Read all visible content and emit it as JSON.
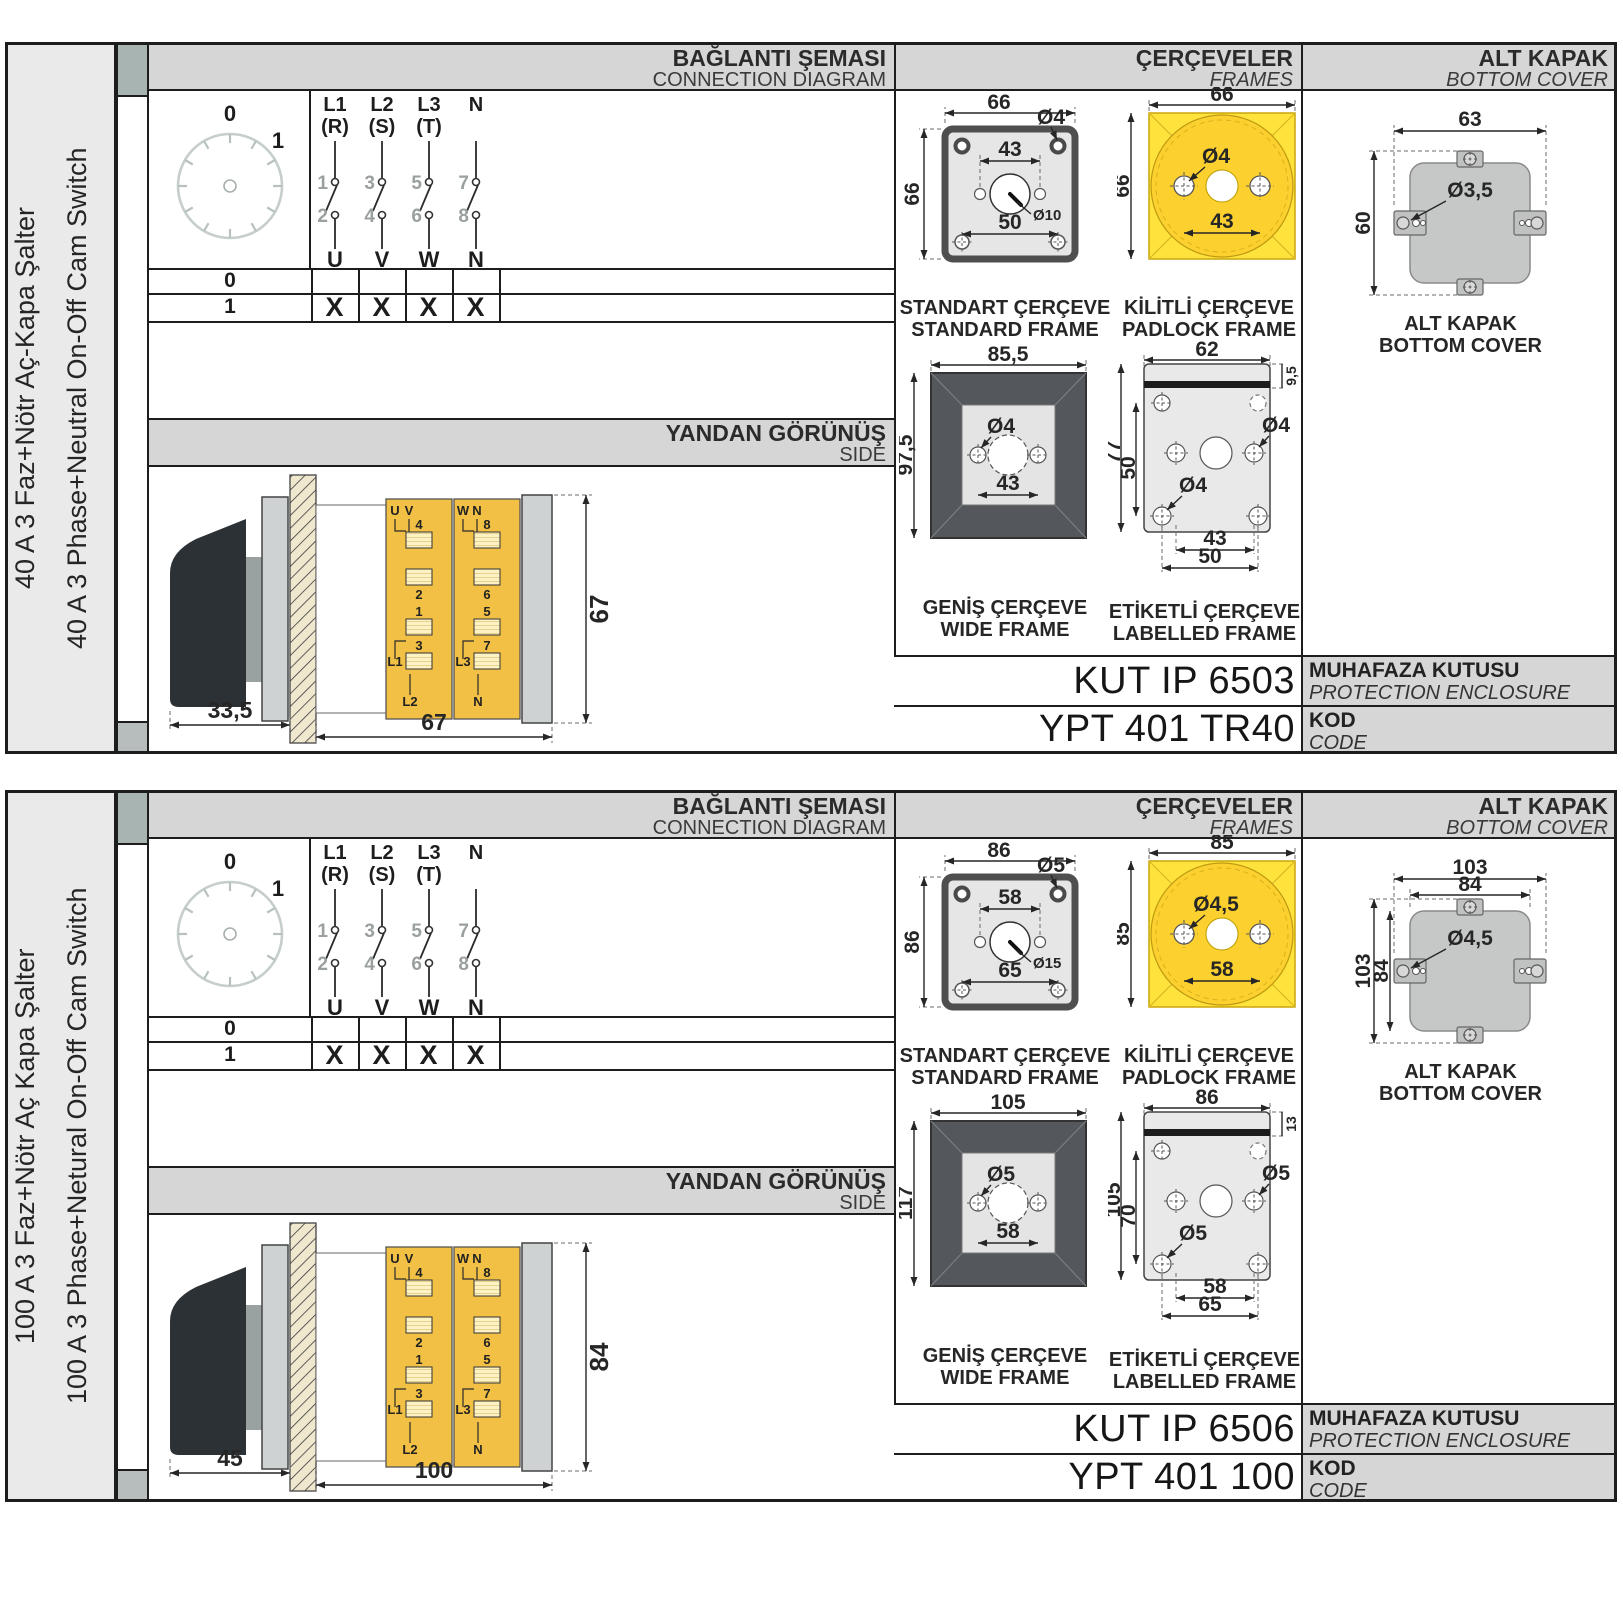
{
  "sections": [
    {
      "sidebar": {
        "tr": "40 A 3 Faz+Nötr Aç-Kapa Şalter",
        "en": "40 A 3 Phase+Neutral On-Off Cam Switch"
      },
      "headers": {
        "connection": {
          "tr": "BAĞLANTI ŞEMASI",
          "en": "CONNECTION DIAGRAM"
        },
        "frames": {
          "tr": "ÇERÇEVELER",
          "en": "FRAMES"
        },
        "cover": {
          "tr": "ALT KAPAK",
          "en": "BOTTOM COVER"
        }
      },
      "diagram": {
        "positions": {
          "off": "0",
          "on": "1"
        },
        "poles": [
          {
            "line": "L1",
            "phase": "(R)",
            "t_in": "1",
            "t_out": "2",
            "out": "U"
          },
          {
            "line": "L2",
            "phase": "(S)",
            "t_in": "3",
            "t_out": "4",
            "out": "V"
          },
          {
            "line": "L3",
            "phase": "(T)",
            "t_in": "5",
            "t_out": "6",
            "out": "W"
          },
          {
            "line": "N",
            "phase": "",
            "t_in": "7",
            "t_out": "8",
            "out": "N"
          }
        ],
        "table": {
          "row_off": {
            "label": "0",
            "marks": [
              "",
              "",
              "",
              ""
            ]
          },
          "row_on": {
            "label": "1",
            "marks": [
              "X",
              "X",
              "X",
              "X"
            ]
          }
        }
      },
      "sideview": {
        "title": {
          "tr": "YANDAN GÖRÜNÜŞ",
          "en": "SIDE"
        },
        "dims": {
          "depth": "33,5",
          "width": "67",
          "height": "67"
        },
        "col1": {
          "top1": "U",
          "top2": "V",
          "n1": "4",
          "n2": "2",
          "n3": "1",
          "n4": "3",
          "b1": "L1",
          "b2": "L2"
        },
        "col2": {
          "top1": "W",
          "top2": "N",
          "n1": "8",
          "n2": "6",
          "n3": "5",
          "n4": "7",
          "b1": "L3",
          "b2": "N"
        }
      },
      "frames": {
        "standard": {
          "caption_tr": "STANDART ÇERÇEVE",
          "caption_en": "STANDARD FRAME",
          "w": "66",
          "h": "66",
          "hole": "Ø4",
          "span": "43",
          "knob": "Ø10",
          "holes_w": "50"
        },
        "padlock": {
          "caption_tr": "KİLİTLİ ÇERÇEVE",
          "caption_en": "PADLOCK FRAME",
          "w": "66",
          "h": "66",
          "hole": "Ø4",
          "span": "43"
        },
        "wide": {
          "caption_tr": "GENİŞ ÇERÇEVE",
          "caption_en": "WIDE FRAME",
          "w": "85,5",
          "h": "97,5",
          "hole": "Ø4",
          "span": "43"
        },
        "labelled": {
          "caption_tr": "ETİKETLİ ÇERÇEVE",
          "caption_en": "LABELLED FRAME",
          "w": "62",
          "strip": "9,5",
          "h": "77",
          "inner_h": "50",
          "hole_top": "Ø4",
          "hole_bottom": "Ø4",
          "span1": "43",
          "span2": "50"
        }
      },
      "cover": {
        "caption_tr": "ALT KAPAK",
        "caption_en": "BOTTOM COVER",
        "w": "63",
        "hole": "Ø3,5",
        "h": "60",
        "extra_class": "hide"
      },
      "codes": {
        "enclosure": {
          "value": "KUT IP 6503",
          "tr": "MUHAFAZA KUTUSU",
          "en": "PROTECTION ENCLOSURE"
        },
        "code": {
          "value": "YPT 401 TR40",
          "tr": "KOD",
          "en": "CODE"
        }
      }
    },
    {
      "sidebar": {
        "tr": "100 A 3 Faz+Nötr Aç Kapa Şalter",
        "en": "100 A 3 Phase+Netural On-Off Cam Switch"
      },
      "headers": {
        "connection": {
          "tr": "BAĞLANTI ŞEMASI",
          "en": "CONNECTION DIAGRAM"
        },
        "frames": {
          "tr": "ÇERÇEVELER",
          "en": "FRAMES"
        },
        "cover": {
          "tr": "ALT KAPAK",
          "en": "BOTTOM COVER"
        }
      },
      "diagram": {
        "positions": {
          "off": "0",
          "on": "1"
        },
        "poles": [
          {
            "line": "L1",
            "phase": "(R)",
            "t_in": "1",
            "t_out": "2",
            "out": "U"
          },
          {
            "line": "L2",
            "phase": "(S)",
            "t_in": "3",
            "t_out": "4",
            "out": "V"
          },
          {
            "line": "L3",
            "phase": "(T)",
            "t_in": "5",
            "t_out": "6",
            "out": "W"
          },
          {
            "line": "N",
            "phase": "",
            "t_in": "7",
            "t_out": "8",
            "out": "N"
          }
        ],
        "table": {
          "row_off": {
            "label": "0",
            "marks": [
              "",
              "",
              "",
              ""
            ]
          },
          "row_on": {
            "label": "1",
            "marks": [
              "X",
              "X",
              "X",
              "X"
            ]
          }
        }
      },
      "sideview": {
        "title": {
          "tr": "YANDAN GÖRÜNÜŞ",
          "en": "SIDE"
        },
        "dims": {
          "depth": "45",
          "width": "100",
          "height": "84"
        },
        "col1": {
          "top1": "U",
          "top2": "V",
          "n1": "4",
          "n2": "2",
          "n3": "1",
          "n4": "3",
          "b1": "L1",
          "b2": "L2"
        },
        "col2": {
          "top1": "W",
          "top2": "N",
          "n1": "8",
          "n2": "6",
          "n3": "5",
          "n4": "7",
          "b1": "L3",
          "b2": "N"
        }
      },
      "frames": {
        "standard": {
          "caption_tr": "STANDART ÇERÇEVE",
          "caption_en": "STANDARD FRAME",
          "w": "86",
          "h": "86",
          "hole": "Ø5",
          "span": "58",
          "knob": "Ø15",
          "holes_w": "65"
        },
        "padlock": {
          "caption_tr": "KİLİTLİ ÇERÇEVE",
          "caption_en": "PADLOCK FRAME",
          "w": "85",
          "h": "85",
          "hole": "Ø4,5",
          "span": "58"
        },
        "wide": {
          "caption_tr": "GENİŞ ÇERÇEVE",
          "caption_en": "WIDE FRAME",
          "w": "105",
          "h": "117",
          "hole": "Ø5",
          "span": "58"
        },
        "labelled": {
          "caption_tr": "ETİKETLİ ÇERÇEVE",
          "caption_en": "LABELLED FRAME",
          "w": "86",
          "strip": "13",
          "h": "105",
          "inner_h": "70",
          "hole_top": "Ø5",
          "hole_bottom": "Ø5",
          "span1": "58",
          "span2": "65"
        }
      },
      "cover": {
        "caption_tr": "ALT KAPAK",
        "caption_en": "BOTTOM COVER",
        "w": "103",
        "w2": "84",
        "hole": "Ø4,5",
        "h": "103",
        "h2": "84",
        "extra_class": "show"
      },
      "codes": {
        "enclosure": {
          "value": "KUT IP 6506",
          "tr": "MUHAFAZA KUTUSU",
          "en": "PROTECTION ENCLOSURE"
        },
        "code": {
          "value": "YPT 401 100",
          "tr": "KOD",
          "en": "CODE"
        }
      }
    }
  ]
}
